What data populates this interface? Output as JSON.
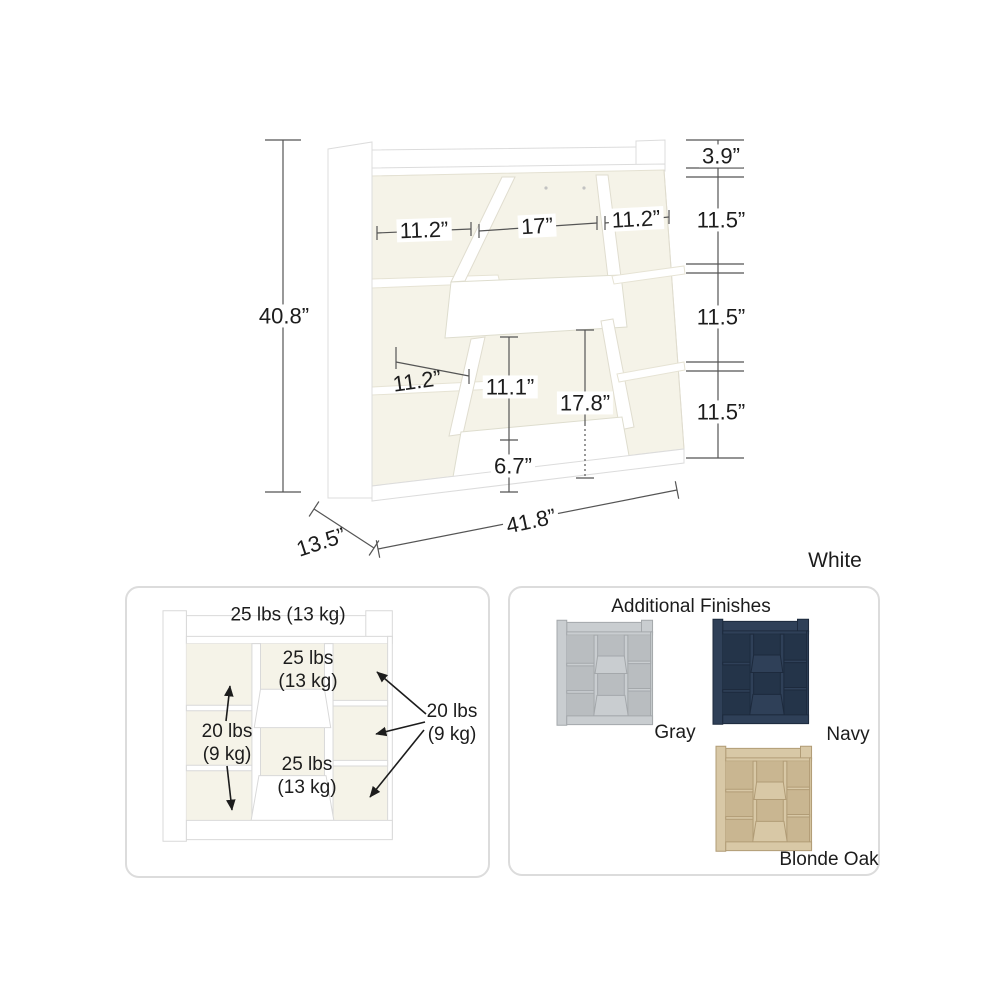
{
  "product_colors": {
    "body": "#ffffff",
    "interior": "#f5f3e8",
    "edge": "#dadada"
  },
  "diagram": {
    "overall_height": "40.8”",
    "overall_width": "41.8”",
    "depth": "13.5”",
    "top_cubby_height": "3.9”",
    "right_sections": [
      "11.5”",
      "11.5”",
      "11.5”"
    ],
    "top_widths": [
      "11.2”",
      "17”",
      "11.2”"
    ],
    "middle_shelf_width": "11.2”",
    "bin_opening_height": "11.1”",
    "bin_total_height": "17.8”",
    "bin_front_height": "6.7”"
  },
  "selected_finish": "White",
  "weight_capacity": {
    "top_shelf": "25 lbs (13 kg)",
    "upper_bin": "25 lbs\n(13 kg)",
    "lower_bin": "25 lbs\n(13 kg)",
    "left_shelves": "20 lbs\n(9 kg)",
    "right_shelves": "20 lbs\n(9 kg)"
  },
  "finishes": {
    "title": "Additional Finishes",
    "options": [
      {
        "label": "Gray",
        "body": "#c9cdd0",
        "interior": "#b9bdc0",
        "edge": "#a4a8ab"
      },
      {
        "label": "Navy",
        "body": "#2f4058",
        "interior": "#243449",
        "edge": "#1d2a3d"
      },
      {
        "label": "Blonde Oak",
        "body": "#d8c8a6",
        "interior": "#c9b691",
        "edge": "#b19c76"
      }
    ]
  }
}
